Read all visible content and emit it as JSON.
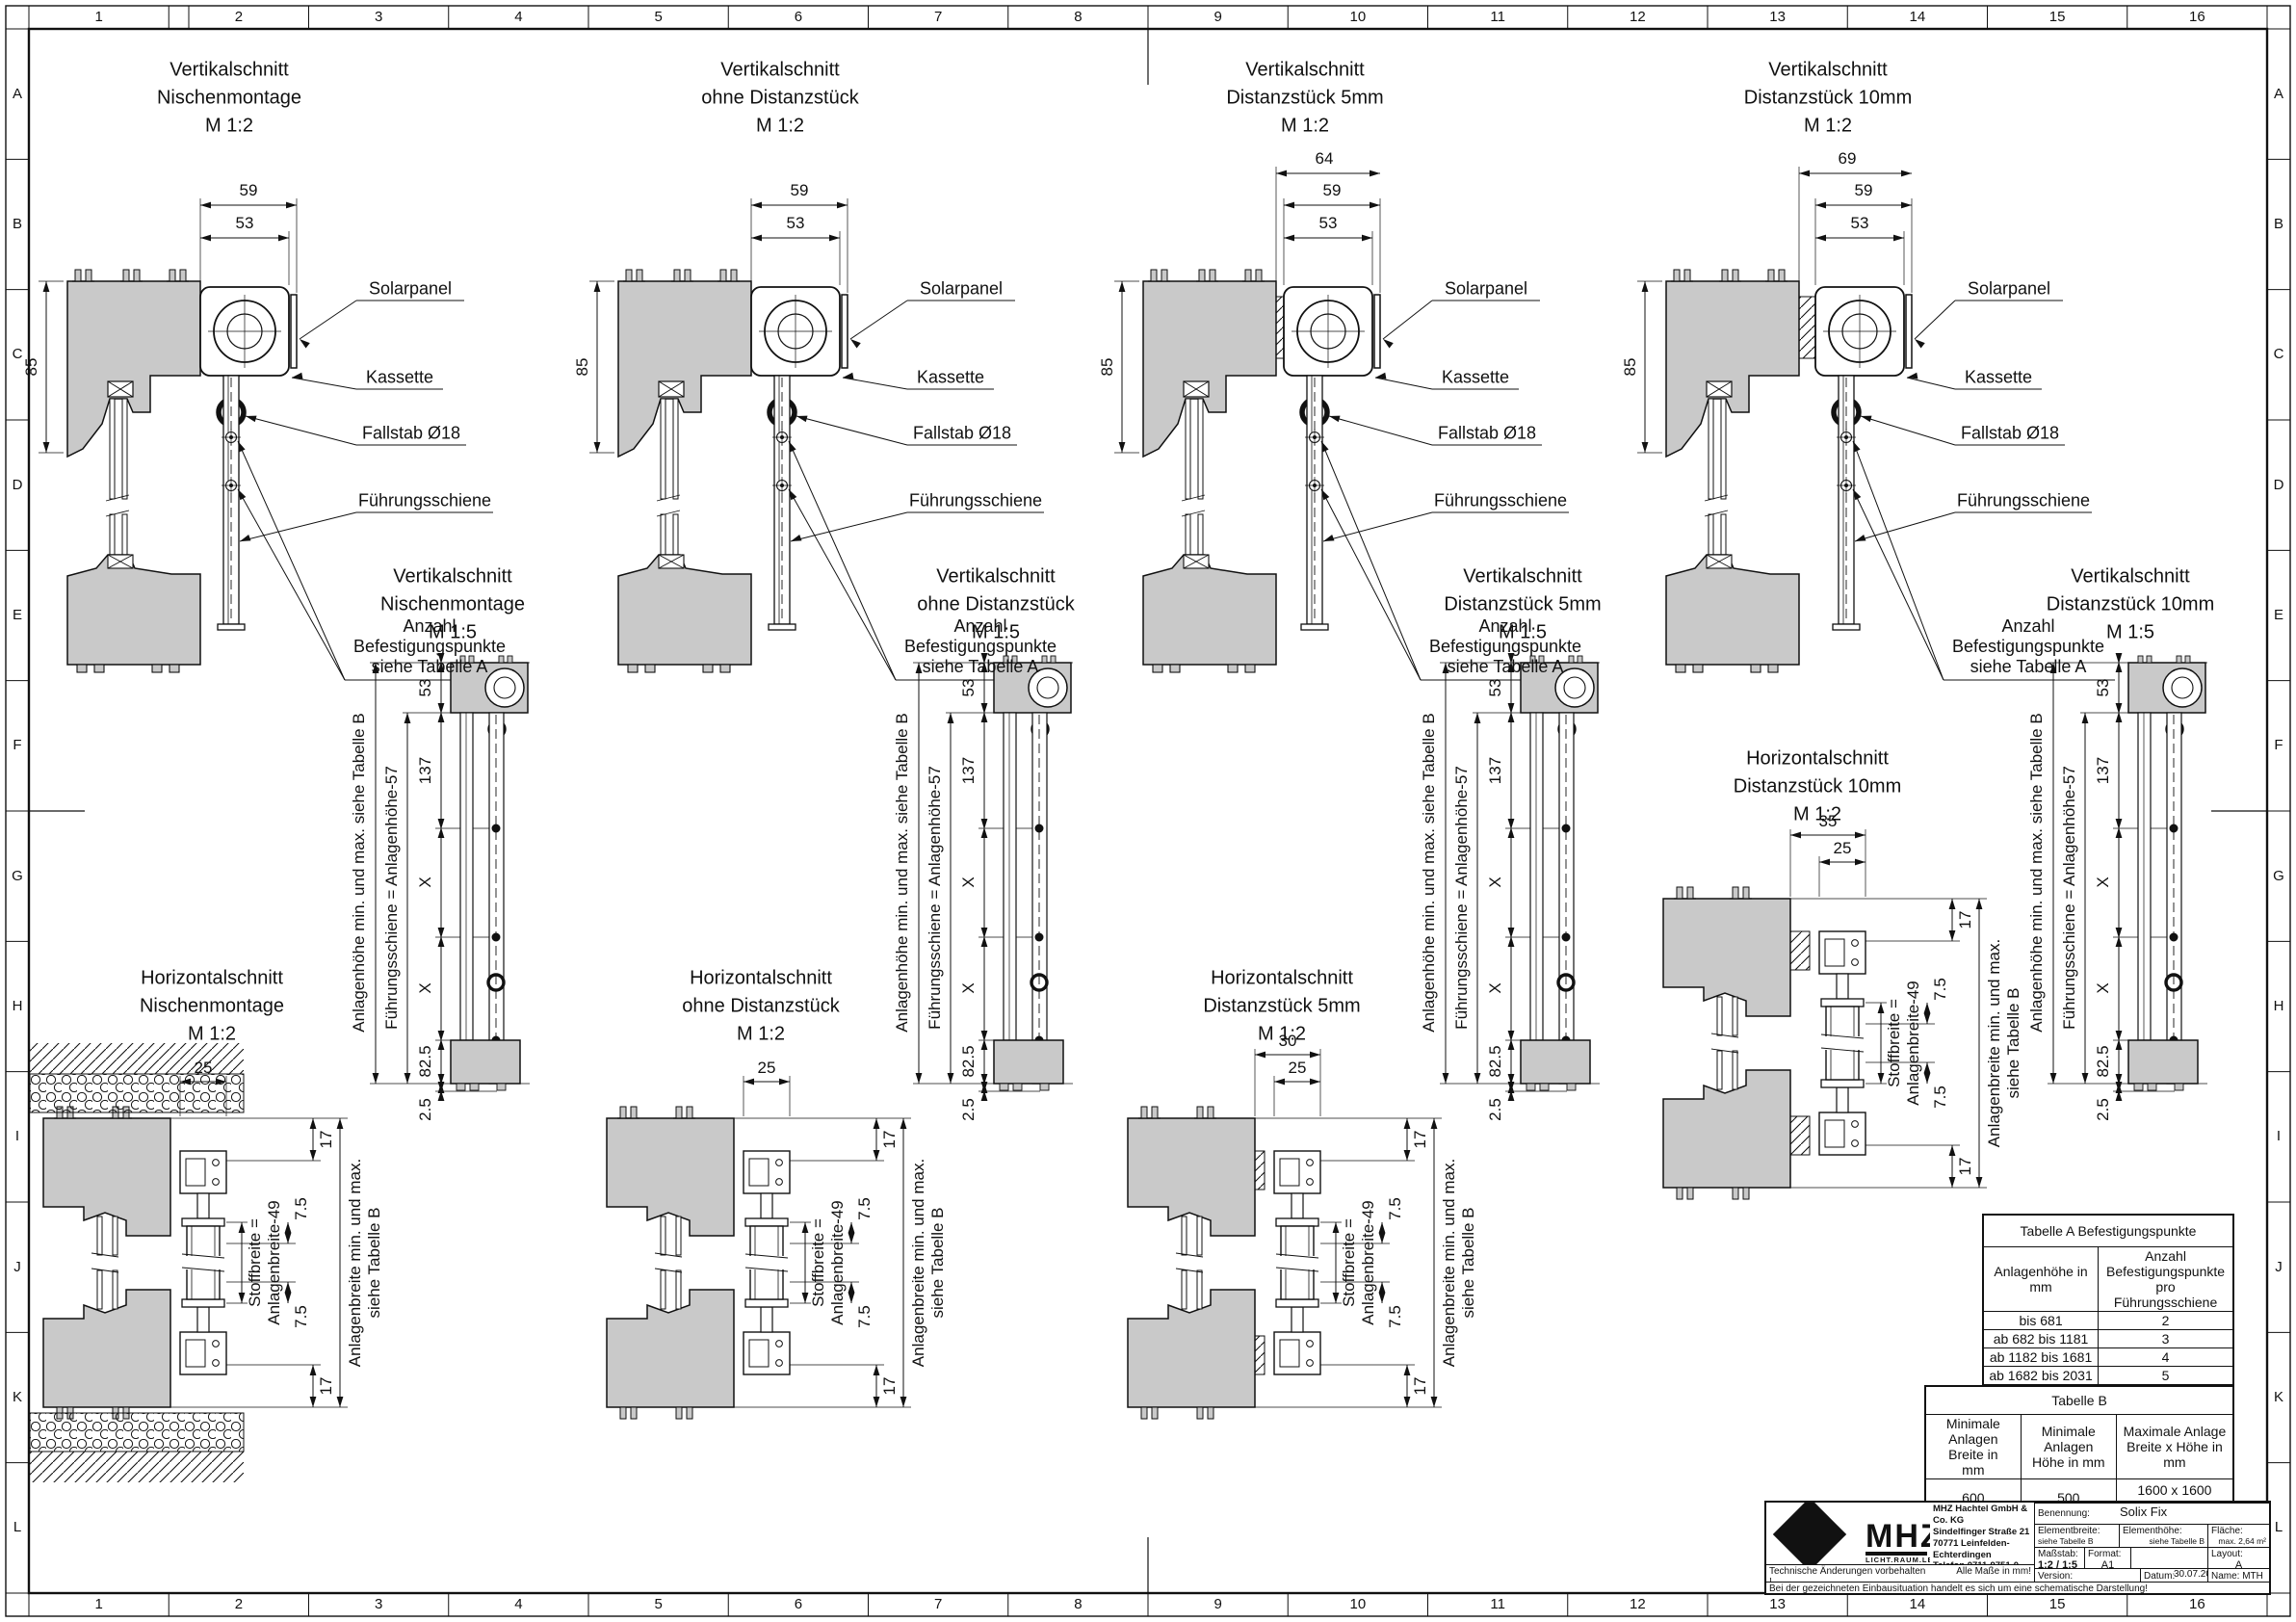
{
  "sheet": {
    "grid_cols": [
      "1",
      "2",
      "3",
      "4",
      "5",
      "6",
      "7",
      "8",
      "9",
      "10",
      "11",
      "12",
      "13",
      "14",
      "15",
      "16"
    ],
    "grid_rows": [
      "A",
      "B",
      "C",
      "D",
      "E",
      "F",
      "G",
      "H",
      "I",
      "J",
      "K",
      "L"
    ],
    "line_color": "#111111",
    "profile_fill": "#c9c9c9"
  },
  "labels": {
    "solarpanel": "Solarpanel",
    "kassette": "Kassette",
    "fallstab": "Fallstab Ø18",
    "fuehrungsschiene": "Führungsschiene",
    "anzahl": "Anzahl\nBefestigungspunkte\nsiehe Tabelle A",
    "anlagenhoehe_side": "Anlagenhöhe min. und max. siehe Tabelle B",
    "fuehrung_side": "Führungsschiene = Anlagenhöhe-57",
    "stoffbreite_side": "Stoffbreite =\nAnlagenbreite-49",
    "anlagenbreite_side": "Anlagenbreite min. und max.\nsiehe Tabelle B"
  },
  "sections": {
    "tv": [
      {
        "title": "Vertikalschnitt\nNischenmontage\nM 1:2",
        "dims": {
          "total": "",
          "outer": "59",
          "inner": "53",
          "height": "85"
        }
      },
      {
        "title": "Vertikalschnitt\nohne Distanzstück\nM 1:2",
        "dims": {
          "total": "",
          "outer": "59",
          "inner": "53",
          "height": "85"
        }
      },
      {
        "title": "Vertikalschnitt\nDistanzstück 5mm\nM 1:2",
        "dims": {
          "total": "64",
          "outer": "59",
          "inner": "53",
          "height": "85"
        }
      },
      {
        "title": "Vertikalschnitt\nDistanzstück 10mm\nM 1:2",
        "dims": {
          "total": "69",
          "outer": "59",
          "inner": "53",
          "height": "85"
        }
      }
    ],
    "mv": [
      {
        "title": "Vertikalschnitt\nNischenmontage\nM 1:5",
        "dims": [
          "53",
          "137",
          "X",
          "X",
          "82.5",
          "2.5"
        ]
      },
      {
        "title": "Vertikalschnitt\nohne Distanzstück\nM 1:5",
        "dims": [
          "53",
          "137",
          "X",
          "X",
          "82.5",
          "2.5"
        ]
      },
      {
        "title": "Vertikalschnitt\nDistanzstück 5mm\nM 1:5",
        "dims": [
          "53",
          "137",
          "X",
          "X",
          "82.5",
          "2.5"
        ]
      },
      {
        "title": "Vertikalschnitt\nDistanzstück 10mm\nM 1:5",
        "dims": [
          "53",
          "137",
          "X",
          "X",
          "82.5",
          "2.5"
        ]
      }
    ],
    "hz": [
      {
        "title": "Horizontalschnitt\nNischenmontage\nM 1:2",
        "dims_top": [
          "25"
        ],
        "dims_right": [
          "17",
          "7.5",
          "7.5",
          "17"
        ]
      },
      {
        "title": "Horizontalschnitt\nohne Distanzstück\nM 1:2",
        "dims_top": [
          "25"
        ],
        "dims_right": [
          "17",
          "7.5",
          "7.5",
          "17"
        ]
      },
      {
        "title": "Horizontalschnitt\nDistanzstück 5mm\nM 1:2",
        "dims_top": [
          "30",
          "25"
        ],
        "dims_right": [
          "17",
          "7.5",
          "7.5",
          "17"
        ]
      },
      {
        "title": "Horizontalschnitt\nDistanzstück 10mm\nM 1:2",
        "dims_top": [
          "35",
          "25"
        ],
        "dims_right": [
          "17",
          "7.5",
          "7.5",
          "17"
        ]
      }
    ]
  },
  "table_a": {
    "title": "Tabelle A Befestigungspunkte",
    "headers": [
      "Anlagenhöhe in\nmm",
      "Anzahl Befestigungspunkte\npro Führungsschiene"
    ],
    "rows": [
      [
        "bis 681",
        "2"
      ],
      [
        "ab 682 bis 1181",
        "3"
      ],
      [
        "ab 1182 bis 1681",
        "4"
      ],
      [
        "ab 1682 bis 2031",
        "5"
      ],
      [
        "ab 2032",
        "6"
      ]
    ]
  },
  "table_b": {
    "title": "Tabelle B",
    "headers": [
      "Minimale\nAnlagen Breite in\nmm",
      "Minimale Anlagen\nHöhe in mm",
      "Maximale Anlage\nBreite x Höhe in mm"
    ],
    "rows": [
      [
        "600",
        "500",
        "1600 x 1600\n1200 x 2200"
      ]
    ]
  },
  "title_block": {
    "logo_text": "MHZ",
    "tagline": "LICHT.RAUM.LEBEN.",
    "address": "MHZ  Hachtel GmbH & Co. KG\nSindelfinger Straße 21\n70771 Leinfelden-Echterdingen\nTelefon 0711-9751-0\nwww.mhz.de",
    "benennung_label": "Benennung:",
    "benennung": "Solix Fix",
    "elementbreite_label": "Elementbreite:",
    "elementbreite": "siehe Tabelle B",
    "elementhoehe_label": "Elementhöhe:",
    "elementhoehe": "siehe Tabelle B",
    "flaeche_label": "Fläche:",
    "flaeche": "max. 2,64 m²",
    "massstab_label": "Maßstab:",
    "massstab": "1:2 / 1:5",
    "format_label": "Format:",
    "format": "A1",
    "layout_label": "Layout:",
    "layout": "A",
    "version_label": "Version:",
    "version": "",
    "datum_label": "Datum:",
    "datum": "30.07.2021",
    "name_label": "Name: MTH",
    "note_tech": "Technische Änderungen vorbehalten !",
    "note_mm": "Alle Maße in mm!",
    "note_schema": "Bei der gezeichneten Einbausituation handelt es sich um eine schematische Darstellung!"
  }
}
